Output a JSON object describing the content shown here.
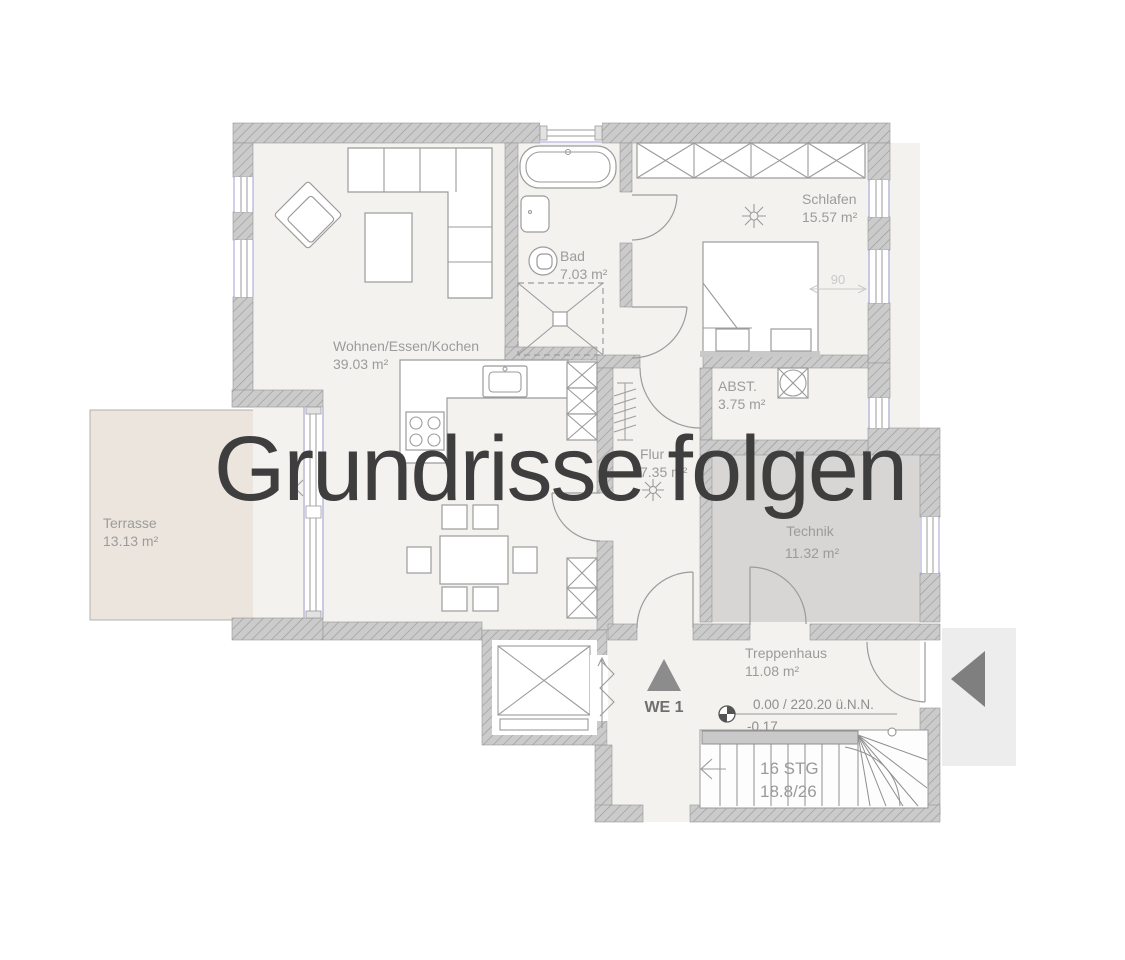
{
  "watermark": {
    "text": "Grundrisse folgen"
  },
  "rooms": {
    "wohnen": {
      "name": "Wohnen/Essen/Kochen",
      "area": "39.03 m²"
    },
    "bad": {
      "name": "Bad",
      "area": "7.03 m²"
    },
    "schlafen": {
      "name": "Schlafen",
      "area": "15.57 m²"
    },
    "abst": {
      "name": "ABST.",
      "area": "3.75 m²"
    },
    "flur": {
      "name": "Flur",
      "area": "7.35 m²"
    },
    "technik": {
      "name": "Technik",
      "area": "11.32 m²"
    },
    "treppenhaus": {
      "name": "Treppenhaus",
      "area": "11.08 m²"
    },
    "terrasse": {
      "name": "Terrasse",
      "area": "13.13 m²"
    }
  },
  "annotations": {
    "unit": "WE 1",
    "level_line1": "0.00 / 220.20 ü.N.N.",
    "level_line2": "-0.17",
    "stairs_line1": "16 STG",
    "stairs_line2": "18.8/26",
    "door_width": "90"
  },
  "colors": {
    "watermark": "#3e3e3e",
    "wall_fill": "#cbcbcb",
    "wall_hatch": "#9b9b9b",
    "floor": "#f4f2ef",
    "technik_floor": "#d7d6d4",
    "terrace": "#ece5de",
    "porch": "#ededed",
    "label": "#9b9b9b",
    "window_accent": "#a0a0d8",
    "arrow_dark": "#7f7f7f"
  }
}
